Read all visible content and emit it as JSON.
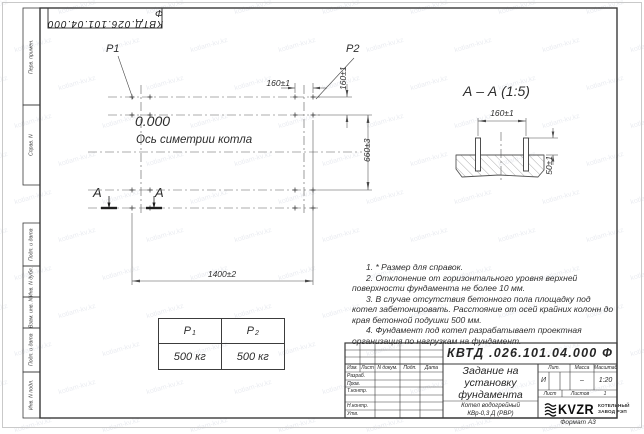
{
  "colors": {
    "ink": "#3a3a3a",
    "watermark": "#c9cdd6"
  },
  "watermark": {
    "text": "kotlam-kv.kz"
  },
  "doc_box": {
    "text": "КВТД.026.101.04.000  Ф"
  },
  "margin_labels": [
    "Перв. примен.",
    "Справ. N",
    "Подп. и дата",
    "Инв. N дубл.",
    "Взам. инв. N",
    "Подп. и дата",
    "Инв. N подл."
  ],
  "plan": {
    "p1": "P1",
    "p2": "P2",
    "elevation": "0.000",
    "axis": "Ось симетрии котла",
    "a_left": "А",
    "a_right": "А",
    "dim_width": "1400±2",
    "dim_height": "660±3",
    "dim_160h": "160±1",
    "dim_160v": "160±1"
  },
  "section": {
    "title": "А – А (1:5)",
    "dim_160": "160±1",
    "dim_50": "50±1"
  },
  "loads": {
    "col1": {
      "base": "P",
      "sub": "1"
    },
    "col2": {
      "base": "P",
      "sub": "2"
    },
    "val1": "500 кг",
    "val2": "500 кг"
  },
  "notes": [
    "1. * Размер для справок.",
    "2. Отклонение от горизонтального уровня верхней поверхности фундамента не более 10 мм.",
    "3. В случае отсутствия бетонного пола площадку под котел забетонировать. Расстояние от осей крайних колонн до края бетонной подушки 500 мм.",
    "4. Фундамент под котел разрабатывает проектная организация по нагрузкам на фундамент."
  ],
  "titleblock": {
    "designation": "КВТД .026.101.04.000  Ф",
    "title_lines": [
      "Задание на",
      "установку",
      "фундамента"
    ],
    "product_lines": [
      "Котел водогрейный",
      "КВр-0,3 Д  (РВР)"
    ],
    "header_cells": [
      "Изм.",
      "Лист",
      "N докум.",
      "Подп.",
      "Дата"
    ],
    "row_labels": [
      "Разраб.",
      "Пров.",
      "Т.контр.",
      "Н.контр.",
      "Утв."
    ],
    "lit_label": "Лит.",
    "mass_label": "Масса",
    "scale_label": "Масштаб",
    "lit_value": "И",
    "mass_value": "–",
    "scale_value": "1:20",
    "sheet_label": "Лист",
    "sheets_label": "Листов",
    "sheets_value": "1",
    "company": {
      "logo": "KVZR",
      "line1": "КОТЕЛЬНЫЙ",
      "line2": "ЗАВОД РЭП"
    },
    "format_label": "Формат А3"
  }
}
